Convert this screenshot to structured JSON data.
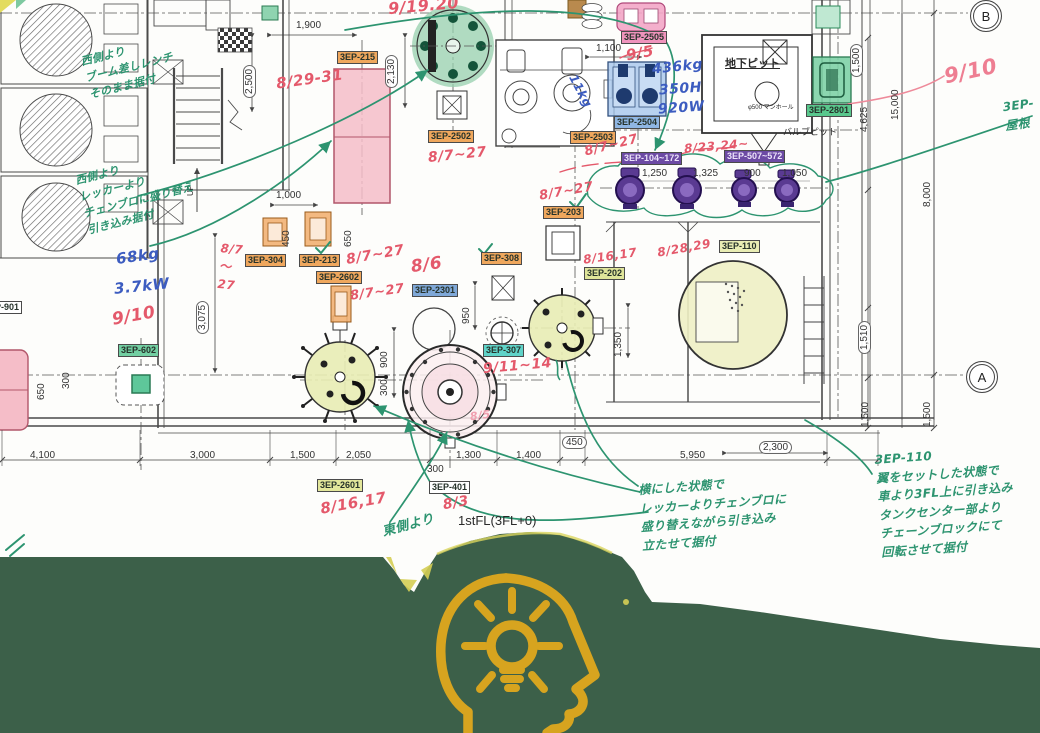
{
  "drawing_title": "equipment-installation-plan",
  "colors": {
    "band": "#3c6049",
    "icon_gold": "#d7a41f",
    "red_ink": "#e4596b",
    "green_ink": "#2d9470",
    "blue_ink": "#3c5cc0"
  },
  "grid_bubbles": [
    {
      "label": "B",
      "x": 970,
      "y": 0
    },
    {
      "label": "A",
      "x": 966,
      "y": 361
    }
  ],
  "equipment_labels": [
    {
      "text": "3EP-215",
      "x": 337,
      "y": 51,
      "bg": "#efa75d"
    },
    {
      "text": "3EP-2502",
      "x": 428,
      "y": 130,
      "bg": "#efa75d"
    },
    {
      "text": "3EP-2503",
      "x": 570,
      "y": 131,
      "bg": "#efa75d"
    },
    {
      "text": "3EP-2504",
      "x": 614,
      "y": 116,
      "bg": "#8fb6e3"
    },
    {
      "text": "3EP-2505",
      "x": 621,
      "y": 31,
      "bg": "#ef93bc"
    },
    {
      "text": "3EP-2801",
      "x": 806,
      "y": 104,
      "bg": "#59c88d"
    },
    {
      "text": "3EP-104~172",
      "x": 621,
      "y": 152,
      "bg": "#6c4aa4",
      "fg": "#ece3fa"
    },
    {
      "text": "3EP-507~572",
      "x": 724,
      "y": 150,
      "bg": "#6c4aa4",
      "fg": "#ece3fa"
    },
    {
      "text": "3EP-203",
      "x": 543,
      "y": 206,
      "bg": "#efa75d"
    },
    {
      "text": "3EP-304",
      "x": 245,
      "y": 254,
      "bg": "#efa75d"
    },
    {
      "text": "3EP-213",
      "x": 299,
      "y": 254,
      "bg": "#efa75d"
    },
    {
      "text": "3EP-2602",
      "x": 316,
      "y": 271,
      "bg": "#efa75d"
    },
    {
      "text": "3EP-308",
      "x": 481,
      "y": 252,
      "bg": "#efa75d"
    },
    {
      "text": "3EP-2301",
      "x": 412,
      "y": 284,
      "bg": "#7fa8d8"
    },
    {
      "text": "3EP-307",
      "x": 483,
      "y": 344,
      "bg": "#5fd3c8"
    },
    {
      "text": "3EP-202",
      "x": 584,
      "y": 267,
      "bg": "#dfe59a"
    },
    {
      "text": "3EP-110",
      "x": 719,
      "y": 240,
      "bg": "#e9edb4"
    },
    {
      "text": "3EP-602",
      "x": 118,
      "y": 344,
      "bg": "#72cfa2"
    },
    {
      "text": "3EP-2601",
      "x": 317,
      "y": 479,
      "bg": "#e3e79b"
    },
    {
      "text": "3EP-401",
      "x": 429,
      "y": 481,
      "bg": "#ffffff"
    },
    {
      "text": "P-901",
      "x": -8,
      "y": 301,
      "bg": "#ffffff"
    }
  ],
  "dimensions": [
    {
      "text": "1,900",
      "x": 296,
      "y": 20
    },
    {
      "text": "2,500",
      "x": 243,
      "y": 98,
      "vert": true,
      "boxed": true
    },
    {
      "text": "2,130",
      "x": 385,
      "y": 88,
      "vert": true,
      "boxed": true
    },
    {
      "text": "1,100",
      "x": 596,
      "y": 43
    },
    {
      "text": "1,000",
      "x": 276,
      "y": 190
    },
    {
      "text": "650",
      "x": 343,
      "y": 247,
      "vert": true
    },
    {
      "text": "450",
      "x": 281,
      "y": 247,
      "vert": true
    },
    {
      "text": "3,075",
      "x": 196,
      "y": 334,
      "vert": true,
      "boxed": true
    },
    {
      "text": "950",
      "x": 461,
      "y": 324,
      "vert": true
    },
    {
      "text": "900",
      "x": 379,
      "y": 368,
      "vert": true
    },
    {
      "text": "300",
      "x": 379,
      "y": 396,
      "vert": true
    },
    {
      "text": "1,350",
      "x": 613,
      "y": 357,
      "vert": true
    },
    {
      "text": "1,250",
      "x": 642,
      "y": 168
    },
    {
      "text": "1,325",
      "x": 693,
      "y": 168
    },
    {
      "text": "900",
      "x": 744,
      "y": 168
    },
    {
      "text": "1,050",
      "x": 782,
      "y": 168
    },
    {
      "text": "4,100",
      "x": 30,
      "y": 450
    },
    {
      "text": "3,000",
      "x": 190,
      "y": 450
    },
    {
      "text": "1,500",
      "x": 290,
      "y": 450
    },
    {
      "text": "2,050",
      "x": 346,
      "y": 450
    },
    {
      "text": "300",
      "x": 427,
      "y": 464
    },
    {
      "text": "1,300",
      "x": 456,
      "y": 450
    },
    {
      "text": "1,400",
      "x": 516,
      "y": 450
    },
    {
      "text": "450",
      "x": 562,
      "y": 436,
      "boxed": true
    },
    {
      "text": "5,950",
      "x": 680,
      "y": 450
    },
    {
      "text": "2,300",
      "x": 759,
      "y": 441,
      "boxed": true
    },
    {
      "text": "4,625",
      "x": 859,
      "y": 132,
      "vert": true
    },
    {
      "text": "15,000",
      "x": 890,
      "y": 120,
      "vert": true
    },
    {
      "text": "8,000",
      "x": 922,
      "y": 207,
      "vert": true
    },
    {
      "text": "1,510",
      "x": 858,
      "y": 354,
      "vert": true,
      "boxed": true
    },
    {
      "text": "1,500",
      "x": 860,
      "y": 427,
      "vert": true
    },
    {
      "text": "1,500",
      "x": 922,
      "y": 427,
      "vert": true
    },
    {
      "text": "1,500",
      "x": 850,
      "y": 77,
      "vert": true,
      "boxed": true
    },
    {
      "text": "650",
      "x": 36,
      "y": 400,
      "vert": true
    },
    {
      "text": "300",
      "x": 61,
      "y": 389,
      "vert": true
    }
  ],
  "red_notes": [
    {
      "text": "9/19.20",
      "x": 388,
      "y": -6,
      "size": 16,
      "rot": -5
    },
    {
      "text": "8/29-31",
      "x": 276,
      "y": 68,
      "size": 15,
      "rot": -8
    },
    {
      "text": "9/5",
      "x": 626,
      "y": 42,
      "size": 15,
      "rot": -10
    },
    {
      "text": "9/10",
      "x": 944,
      "y": 56,
      "size": 21,
      "rot": -12,
      "color": "#ee7e92"
    },
    {
      "text": "8/7~27",
      "x": 428,
      "y": 145,
      "size": 14,
      "rot": -6
    },
    {
      "text": "8/7~27",
      "x": 584,
      "y": 136,
      "size": 13,
      "rot": -14
    },
    {
      "text": "8/23,24~",
      "x": 684,
      "y": 137,
      "size": 12,
      "rot": -5
    },
    {
      "text": "8/7~27",
      "x": 539,
      "y": 182,
      "size": 13,
      "rot": -10
    },
    {
      "text": "8/7\n〜\n27",
      "x": 219,
      "y": 240,
      "size": 12,
      "rot": 5
    },
    {
      "text": "8/7~27",
      "x": 346,
      "y": 245,
      "size": 14,
      "rot": -10
    },
    {
      "text": "8/7~27",
      "x": 350,
      "y": 283,
      "size": 13,
      "rot": -8
    },
    {
      "text": "8/6",
      "x": 411,
      "y": 253,
      "size": 17,
      "rot": -8
    },
    {
      "text": "9/11~14",
      "x": 483,
      "y": 356,
      "size": 14,
      "rot": -5
    },
    {
      "text": "8/16,17",
      "x": 583,
      "y": 247,
      "size": 12,
      "rot": -8
    },
    {
      "text": "8/28,29",
      "x": 657,
      "y": 239,
      "size": 12,
      "rot": -10
    },
    {
      "text": "8/16,17",
      "x": 320,
      "y": 492,
      "size": 15,
      "rot": -10
    },
    {
      "text": "8/3",
      "x": 443,
      "y": 493,
      "size": 14,
      "rot": -10
    },
    {
      "text": "8/5",
      "x": 470,
      "y": 408,
      "size": 11,
      "rot": -8,
      "color": "#f0a0b0"
    },
    {
      "text": "9/10",
      "x": 112,
      "y": 304,
      "size": 17,
      "rot": -10
    }
  ],
  "blue_notes": [
    {
      "text": "436kg",
      "x": 652,
      "y": 57,
      "size": 14,
      "rot": -6
    },
    {
      "text": "350H",
      "x": 659,
      "y": 79,
      "size": 14,
      "rot": -4
    },
    {
      "text": "920W",
      "x": 658,
      "y": 98,
      "size": 14,
      "rot": -4
    },
    {
      "text": "11kg",
      "x": 563,
      "y": 82,
      "size": 12,
      "rot": 62
    },
    {
      "text": "68kg",
      "x": 116,
      "y": 245,
      "size": 15,
      "rot": -8
    },
    {
      "text": "3.7kW",
      "x": 114,
      "y": 275,
      "size": 15,
      "rot": -6
    }
  ],
  "green_notes": [
    {
      "text": "西側より\nブーム差しレンチ\nそのまま据付",
      "x": 84,
      "y": 42,
      "size": 11,
      "rot": -14
    },
    {
      "text": "西側より\nレッカーより\nチェンブロに盛り替え\n引き込み据付",
      "x": 80,
      "y": 158,
      "size": 11,
      "rot": -14
    },
    {
      "text": "3EP-\n屋根",
      "x": 1004,
      "y": 96,
      "size": 12,
      "rot": -8
    },
    {
      "text": "横にした状態で\nレッカーよりチェンブロに\n盛り替えながら引き込み\n立たせて据付",
      "x": 640,
      "y": 476,
      "size": 12,
      "rot": -4
    },
    {
      "text": "3EP-110\n翼をセットした状態で\n車より3FL上に引き込み\nタンクセンター部より\nチェーンブロックにて\n回転させて据付",
      "x": 878,
      "y": 446,
      "size": 12,
      "rot": -4
    },
    {
      "text": "東側より",
      "x": 382,
      "y": 516,
      "size": 13,
      "rot": -15
    }
  ],
  "black_texts": [
    {
      "text": "地下ピット",
      "x": 725,
      "y": 58,
      "size": 11,
      "bold": true,
      "underline": true
    },
    {
      "text": "φ500 マンホール",
      "x": 748,
      "y": 105,
      "size": 6
    },
    {
      "text": "バルブピット",
      "x": 783,
      "y": 127,
      "size": 9
    },
    {
      "text": "1stFL(3FL+0)",
      "x": 458,
      "y": 513,
      "size": 13
    },
    {
      "text": "UP",
      "x": 186,
      "y": 196,
      "size": 8,
      "vert": true
    }
  ],
  "footer": {
    "icon": "idea-head-icon"
  }
}
